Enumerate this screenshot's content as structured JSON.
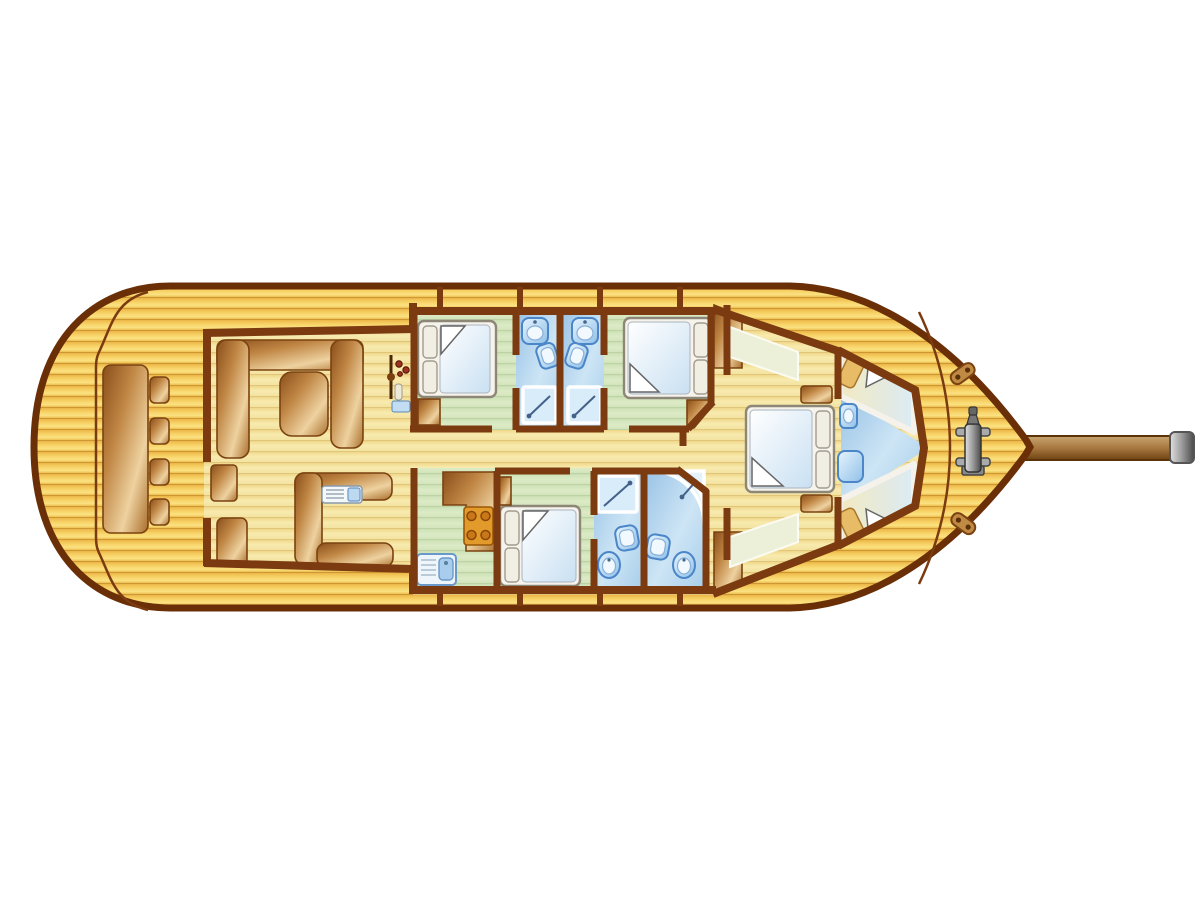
{
  "document": {
    "type": "boat-deck-plan",
    "view": "top-down floor plan of a motorsailer / gulet style yacht, bow pointing right",
    "visible_text": []
  },
  "colors": {
    "bg": "#ffffff",
    "wall": "#7b3a10",
    "hull": "#6b2f08",
    "woodstroke": "#7a4210",
    "fixstroke": "#4a86c8",
    "deck-plank-dark": "#b98225",
    "deck-plank-light": "#fbe282",
    "interior-plank": "#f8ebae",
    "cabin-floor-green": "#dbeac6",
    "bath-floor-blue": "#aed2ec",
    "furniture-wood-dark": "#8a4e1a",
    "furniture-wood-light": "#eed2a0",
    "bed-frame": "#f6f3ec",
    "mattress-blue": "#c9e0f2",
    "fixture-blue": "#7fb4e4",
    "metal-gray": "#9a9a9a"
  },
  "vessel": {
    "areas": [
      {
        "name": "aft-deck",
        "furniture": [
          "long table",
          "four stools",
          "cockpit coaming line"
        ]
      },
      {
        "name": "salon",
        "furniture": [
          "u-shaped sofa",
          "salon table",
          "helm station with wheel and instruments",
          "companionway step",
          "bench seat",
          "l-shaped galley counter with appliance",
          "lower shelf"
        ]
      },
      {
        "name": "cabin-port-aft",
        "furniture": [
          "double bed",
          "corner wardrobe"
        ]
      },
      {
        "name": "bathroom-port-1",
        "furniture": [
          "sink",
          "toilet",
          "shower"
        ]
      },
      {
        "name": "bathroom-port-2",
        "furniture": [
          "sink",
          "toilet",
          "shower"
        ]
      },
      {
        "name": "cabin-port-fwd",
        "furniture": [
          "double bed",
          "corner cabinet"
        ]
      },
      {
        "name": "galley",
        "furniture": [
          "counter",
          "four-burner stove",
          "sink with drainer"
        ]
      },
      {
        "name": "cabin-starboard",
        "furniture": [
          "double bed",
          "nightstand"
        ]
      },
      {
        "name": "bathroom-starboard-1",
        "furniture": [
          "shower",
          "sink",
          "toilet"
        ]
      },
      {
        "name": "bathroom-starboard-2",
        "furniture": [
          "quadrant shower",
          "sink",
          "toilet"
        ]
      },
      {
        "name": "master-cabin",
        "furniture": [
          "double bed",
          "two nightstands",
          "two side benches",
          "two wardrobes"
        ]
      },
      {
        "name": "bow-cabin",
        "furniture": [
          "two v-berths",
          "sink",
          "seat"
        ]
      },
      {
        "name": "foredeck",
        "furniture": [
          "windlass",
          "two cleats",
          "toe-rail",
          "bowsprit"
        ]
      }
    ]
  }
}
